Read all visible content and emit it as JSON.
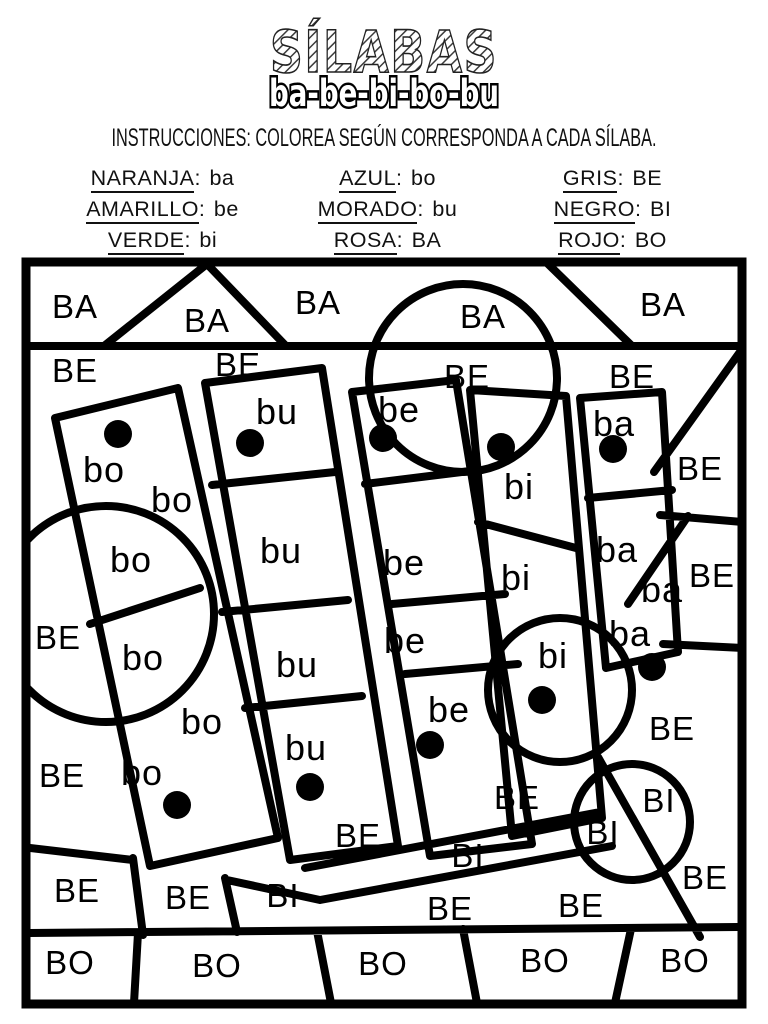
{
  "header": {
    "title": "SÍLABAS",
    "subtitle": "ba-be-bi-bo-bu",
    "instructions": "INSTRUCCIONES: COLOREA SEGÚN CORRESPONDA A CADA SÍLABA."
  },
  "key": {
    "columns": [
      {
        "entries": [
          {
            "color": "NARANJA",
            "syllable": "ba"
          },
          {
            "color": "AMARILLO",
            "syllable": "be"
          },
          {
            "color": "VERDE",
            "syllable": "bi"
          }
        ]
      },
      {
        "entries": [
          {
            "color": "AZUL",
            "syllable": "bo"
          },
          {
            "color": "MORADO",
            "syllable": "bu"
          },
          {
            "color": "ROSA",
            "syllable": "BA"
          }
        ]
      },
      {
        "entries": [
          {
            "color": "GRIS",
            "syllable": "BE"
          },
          {
            "color": "NEGRO",
            "syllable": "BI"
          },
          {
            "color": "ROJO",
            "syllable": "BO"
          }
        ]
      }
    ]
  },
  "puzzle": {
    "ink_color": "#000000",
    "labels": [
      {
        "t": "BA",
        "x": 75,
        "y": 318,
        "s": 33
      },
      {
        "t": "BA",
        "x": 207,
        "y": 332,
        "s": 33
      },
      {
        "t": "BA",
        "x": 318,
        "y": 314,
        "s": 33
      },
      {
        "t": "BA",
        "x": 483,
        "y": 328,
        "s": 33
      },
      {
        "t": "BA",
        "x": 663,
        "y": 316,
        "s": 33
      },
      {
        "t": "BE",
        "x": 75,
        "y": 382,
        "s": 33
      },
      {
        "t": "BE",
        "x": 238,
        "y": 376,
        "s": 33
      },
      {
        "t": "BE",
        "x": 467,
        "y": 388,
        "s": 33
      },
      {
        "t": "BE",
        "x": 632,
        "y": 388,
        "s": 33
      },
      {
        "t": "BE",
        "x": 700,
        "y": 480,
        "s": 33
      },
      {
        "t": "BE",
        "x": 712,
        "y": 587,
        "s": 33
      },
      {
        "t": "bu",
        "x": 277,
        "y": 424,
        "s": 36
      },
      {
        "t": "be",
        "x": 399,
        "y": 422,
        "s": 36
      },
      {
        "t": "ba",
        "x": 614,
        "y": 436,
        "s": 36
      },
      {
        "t": "bo",
        "x": 104,
        "y": 482,
        "s": 36
      },
      {
        "t": "bo",
        "x": 172,
        "y": 512,
        "s": 36
      },
      {
        "t": "bi",
        "x": 519,
        "y": 499,
        "s": 36
      },
      {
        "t": "bo",
        "x": 131,
        "y": 572,
        "s": 36
      },
      {
        "t": "bu",
        "x": 281,
        "y": 563,
        "s": 36
      },
      {
        "t": "be",
        "x": 404,
        "y": 575,
        "s": 36
      },
      {
        "t": "bi",
        "x": 516,
        "y": 590,
        "s": 36
      },
      {
        "t": "ba",
        "x": 617,
        "y": 562,
        "s": 36
      },
      {
        "t": "ba",
        "x": 662,
        "y": 602,
        "s": 36
      },
      {
        "t": "BE",
        "x": 58,
        "y": 649,
        "s": 33
      },
      {
        "t": "bo",
        "x": 143,
        "y": 670,
        "s": 36
      },
      {
        "t": "bu",
        "x": 297,
        "y": 677,
        "s": 36
      },
      {
        "t": "be",
        "x": 405,
        "y": 653,
        "s": 36
      },
      {
        "t": "ba",
        "x": 630,
        "y": 646,
        "s": 36
      },
      {
        "t": "bi",
        "x": 553,
        "y": 668,
        "s": 36
      },
      {
        "t": "be",
        "x": 449,
        "y": 722,
        "s": 36
      },
      {
        "t": "bo",
        "x": 202,
        "y": 734,
        "s": 36
      },
      {
        "t": "bu",
        "x": 306,
        "y": 760,
        "s": 36
      },
      {
        "t": "BE",
        "x": 62,
        "y": 787,
        "s": 33
      },
      {
        "t": "bo",
        "x": 142,
        "y": 785,
        "s": 36
      },
      {
        "t": "BE",
        "x": 672,
        "y": 740,
        "s": 33
      },
      {
        "t": "BI",
        "x": 659,
        "y": 812,
        "s": 33
      },
      {
        "t": "BI",
        "x": 603,
        "y": 844,
        "s": 33
      },
      {
        "t": "BI",
        "x": 468,
        "y": 867,
        "s": 33
      },
      {
        "t": "BE",
        "x": 517,
        "y": 809,
        "s": 33
      },
      {
        "t": "BE",
        "x": 358,
        "y": 847,
        "s": 33
      },
      {
        "t": "BE",
        "x": 77,
        "y": 902,
        "s": 33
      },
      {
        "t": "BE",
        "x": 188,
        "y": 909,
        "s": 33
      },
      {
        "t": "BI",
        "x": 283,
        "y": 907,
        "s": 33
      },
      {
        "t": "BE",
        "x": 705,
        "y": 889,
        "s": 33
      },
      {
        "t": "BE",
        "x": 450,
        "y": 920,
        "s": 33
      },
      {
        "t": "BE",
        "x": 581,
        "y": 917,
        "s": 33
      },
      {
        "t": "BO",
        "x": 70,
        "y": 974,
        "s": 33
      },
      {
        "t": "BO",
        "x": 217,
        "y": 977,
        "s": 33
      },
      {
        "t": "BO",
        "x": 383,
        "y": 975,
        "s": 33
      },
      {
        "t": "BO",
        "x": 545,
        "y": 972,
        "s": 33
      },
      {
        "t": "BO",
        "x": 685,
        "y": 972,
        "s": 33
      }
    ],
    "dots": [
      {
        "x": 118,
        "y": 434
      },
      {
        "x": 250,
        "y": 443
      },
      {
        "x": 383,
        "y": 438
      },
      {
        "x": 501,
        "y": 447
      },
      {
        "x": 613,
        "y": 449
      },
      {
        "x": 542,
        "y": 700
      },
      {
        "x": 652,
        "y": 667
      },
      {
        "x": 430,
        "y": 745
      },
      {
        "x": 310,
        "y": 787
      },
      {
        "x": 177,
        "y": 805
      }
    ]
  }
}
